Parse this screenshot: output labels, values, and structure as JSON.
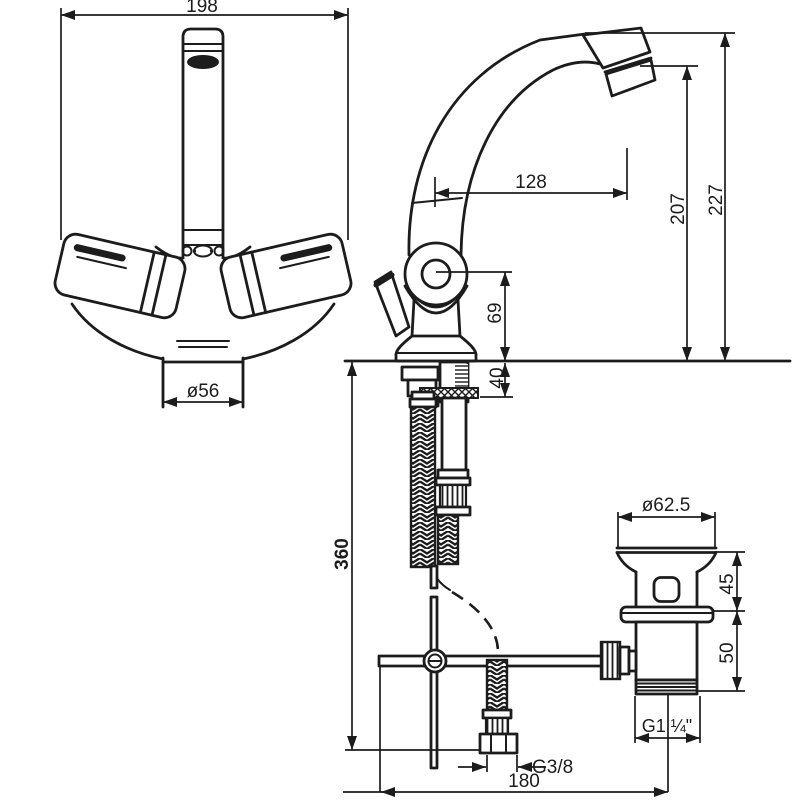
{
  "drawing": {
    "type": "faucet-installation-technical-drawing",
    "style": {
      "ink_color": "#1c1c1c",
      "background_color": "#ffffff"
    },
    "dimensions": {
      "front_width": "198",
      "spout_reach": "128",
      "outlet_height": "207",
      "overall_height": "227",
      "body_center_height": "69",
      "deck_thickness": "40",
      "base_diameter": "ø56",
      "hose_length": "360",
      "drain_top_diameter": "ø62.5",
      "drain_upper_height": "45",
      "drain_lower_height": "50",
      "hose_thread": "G3/8",
      "drain_thread": "G1 ¼\"",
      "drain_offset": "180"
    }
  }
}
